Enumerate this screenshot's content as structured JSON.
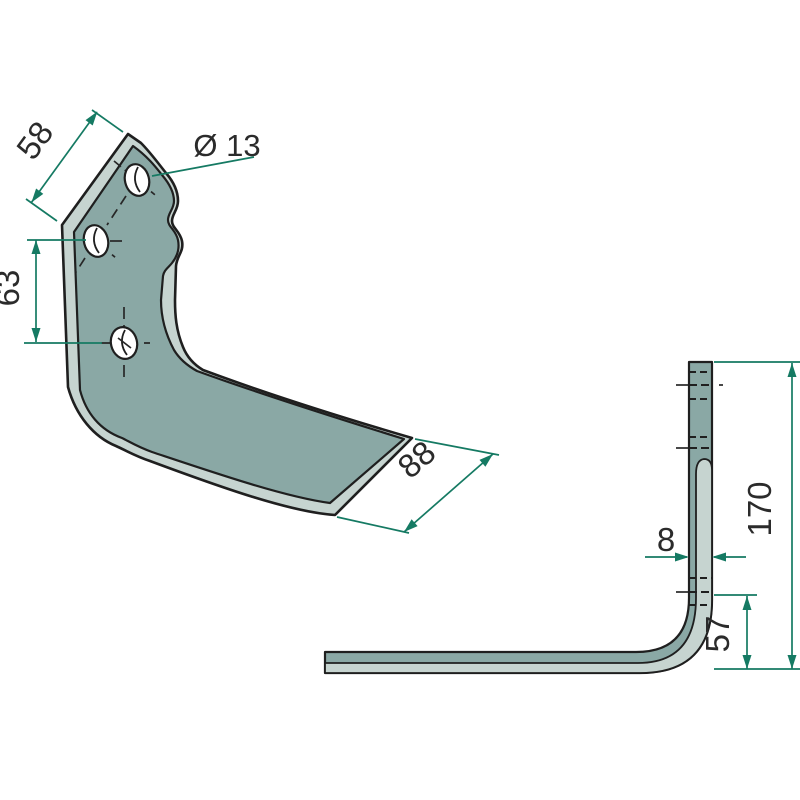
{
  "drawing": {
    "type": "technical-drawing",
    "part": "angled tiller blade with three mounting holes",
    "views": {
      "front": "front-view-of-blade",
      "side": "side-profile-view"
    }
  },
  "dimensions": {
    "top_edge_width": "58",
    "hole_diameter": "Ø 13",
    "hole_spacing": "63",
    "blade_width": "88",
    "material_thickness": "8",
    "bend_height": "57",
    "total_height": "170"
  },
  "colors": {
    "background": "#ffffff",
    "face": "#8aa8a5",
    "bevel": "#c6d4d0",
    "outline": "#1f1f1f",
    "dimension_line": "#157a63",
    "dimension_text": "#2b2b2b"
  }
}
